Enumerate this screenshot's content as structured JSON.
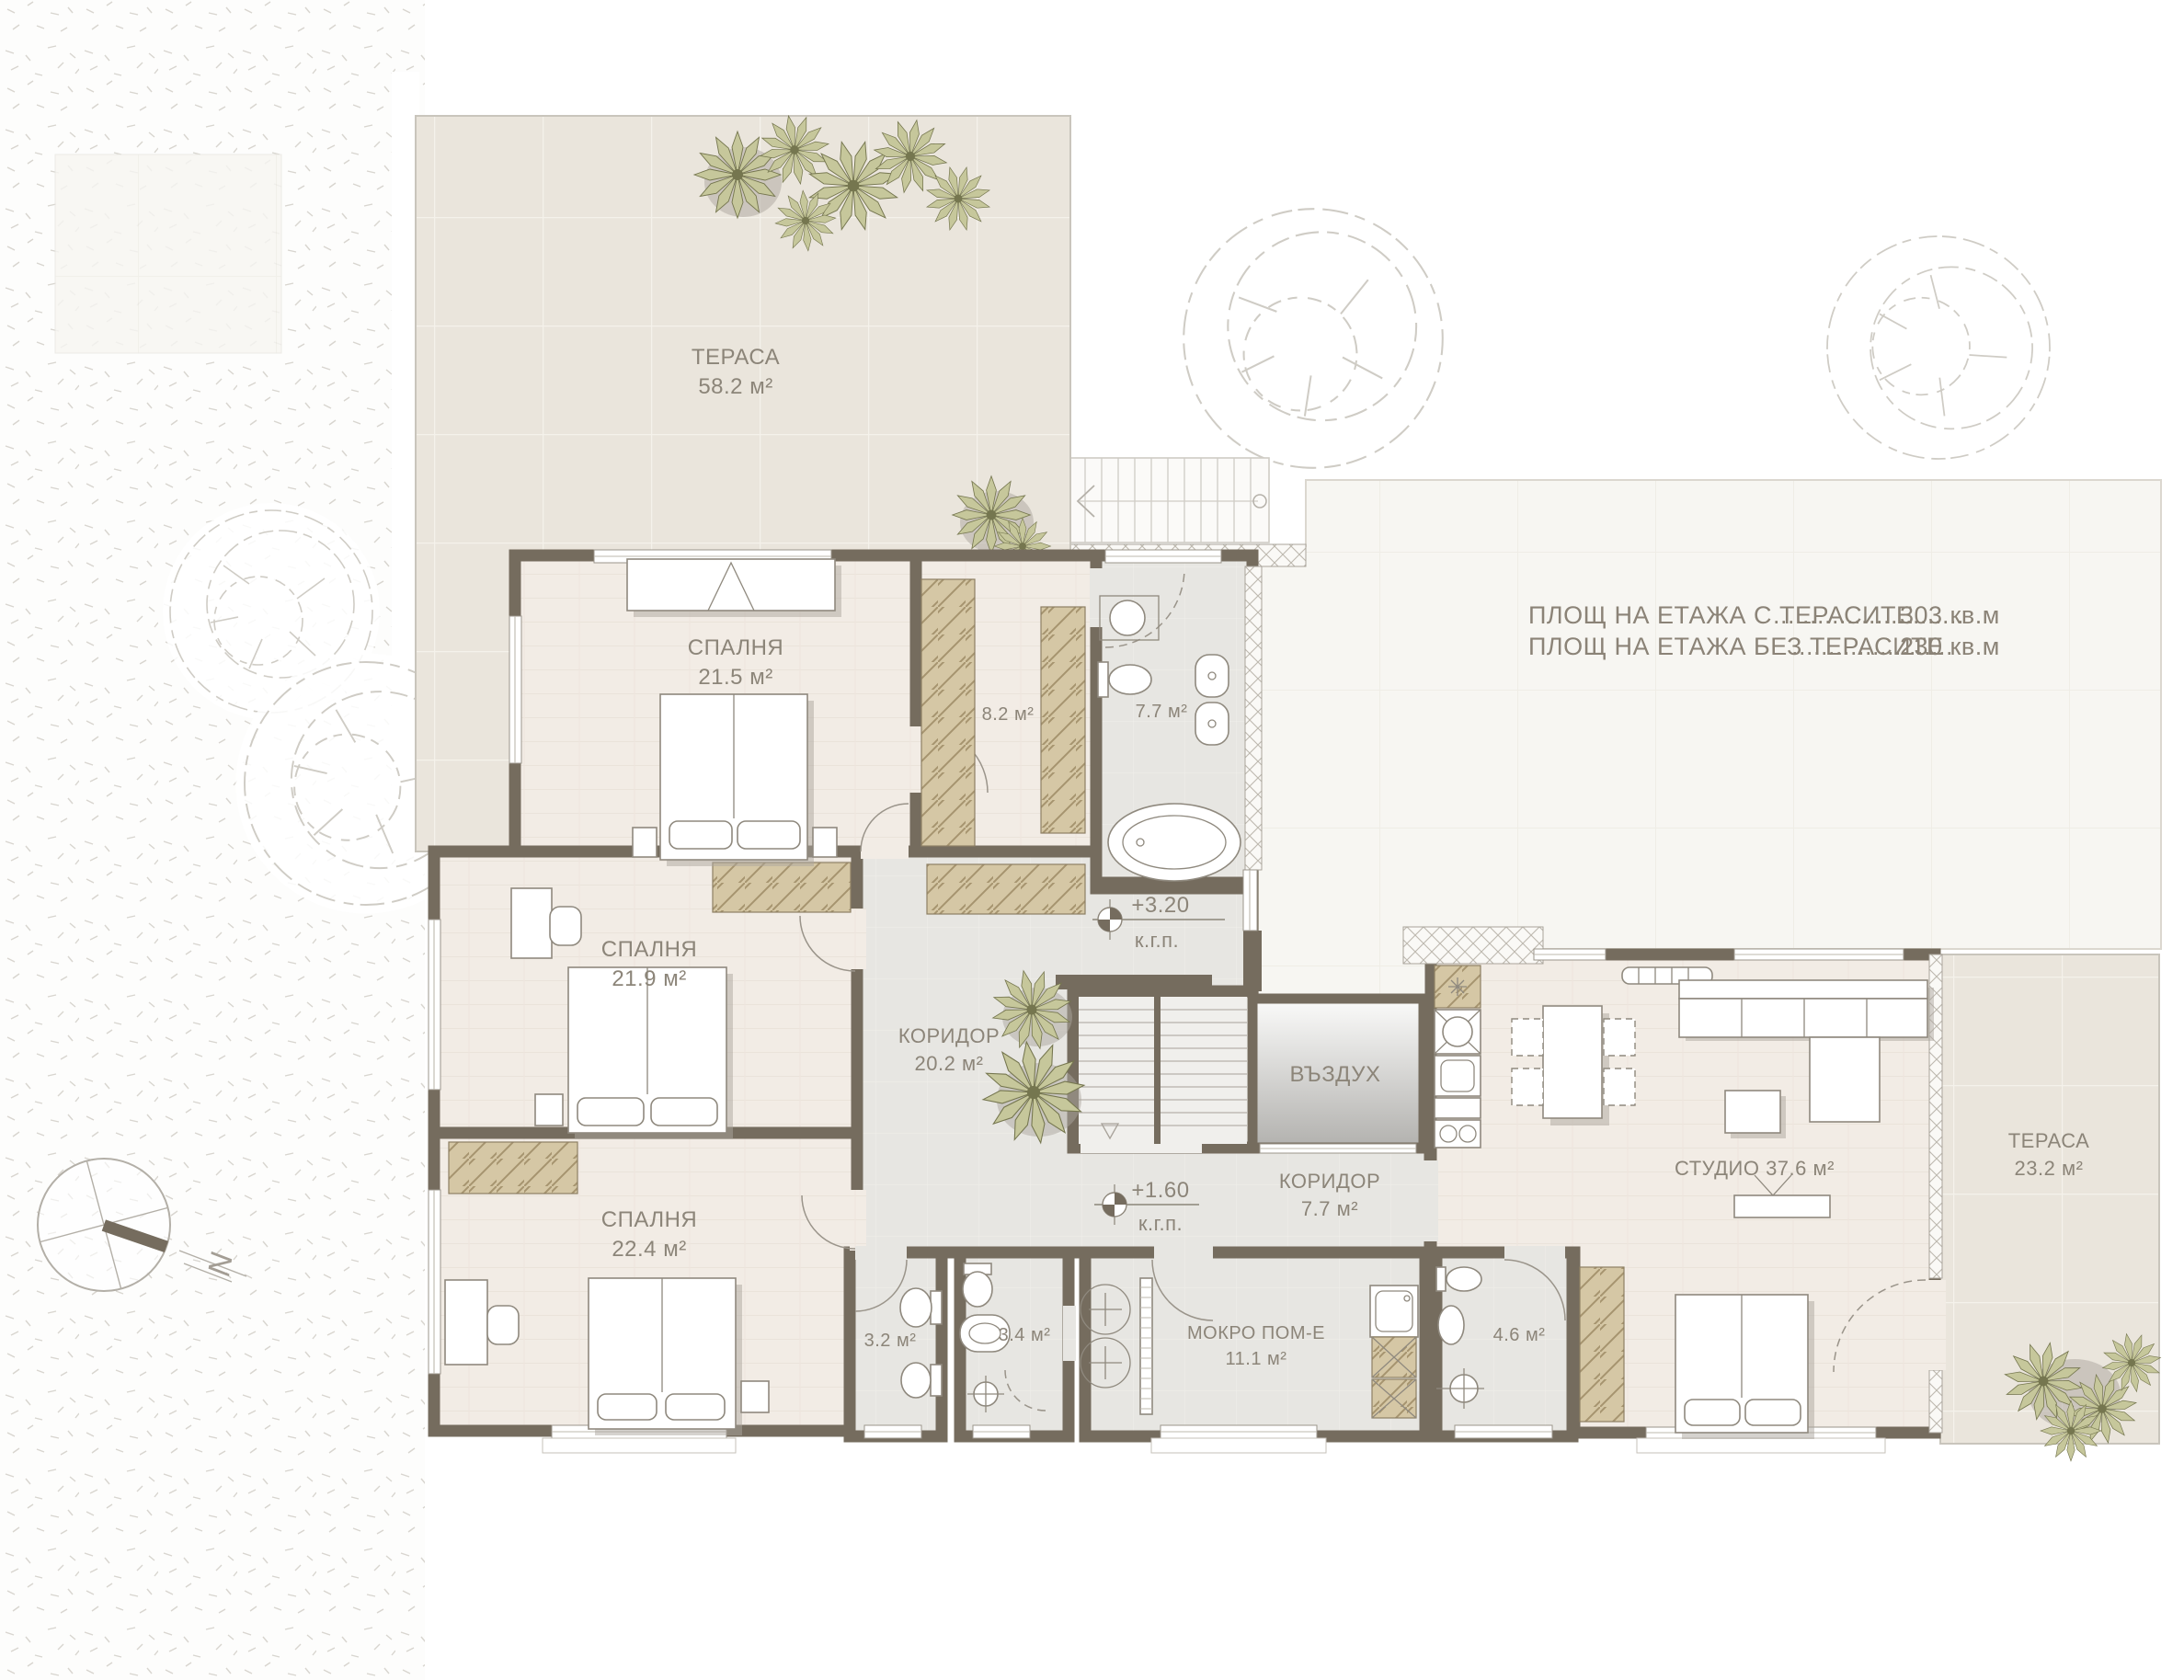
{
  "rooms": {
    "terrace_top": {
      "name": "ТЕРАСА",
      "area": "58.2 м²"
    },
    "bedroom_1": {
      "name": "СПАЛНЯ",
      "area": "21.5 м²"
    },
    "closet": {
      "area": "8.2 м²"
    },
    "bath_main": {
      "area": "7.7 м²"
    },
    "bedroom_2": {
      "name": "СПАЛНЯ",
      "area": "21.9 м²"
    },
    "corridor_main": {
      "name": "КОРИДОР",
      "area": "20.2 м²"
    },
    "air_shaft": {
      "name": "ВЪЗДУХ"
    },
    "bedroom_3": {
      "name": "СПАЛНЯ",
      "area": "22.4 м²"
    },
    "corridor_small": {
      "name": "КОРИДОР",
      "area": "7.7 м²"
    },
    "wc_1": {
      "area": "3.2 м²"
    },
    "wc_2": {
      "area": "3.4 м²"
    },
    "wet_room": {
      "name": "МОКРО ПОМ-Е",
      "area": "11.1 м²"
    },
    "wc_3": {
      "area": "4.6 м²"
    },
    "studio": {
      "name": "СТУДИО 37.6 м²"
    },
    "terrace_right": {
      "name": "ТЕРАСА",
      "area": "23.2 м²"
    }
  },
  "summary": {
    "rows": [
      {
        "label": "ПЛОЩ НА ЕТАЖА С ТЕРАСИТЕ",
        "dots": "..........................",
        "value": "303 кв.м"
      },
      {
        "label": "ПЛОЩ НА ЕТАЖА БЕЗ ТЕРАСИТЕ",
        "dots": "......................",
        "value": "230 кв.м"
      }
    ]
  },
  "levels": [
    {
      "value": "+3.20",
      "datum": "к.г.п."
    },
    {
      "value": "+1.60",
      "datum": "к.г.п."
    }
  ],
  "compass": {
    "north_label": "N"
  },
  "colors": {
    "wall": "#756C5E",
    "terrace_tile": "#EAE5DC",
    "wood_floor": "#F2ECE5",
    "gray_floor": "#E7E6E2",
    "wardrobe": "#D5C7A5",
    "plant": "#C6C79B",
    "label_text": "#8C8579"
  }
}
